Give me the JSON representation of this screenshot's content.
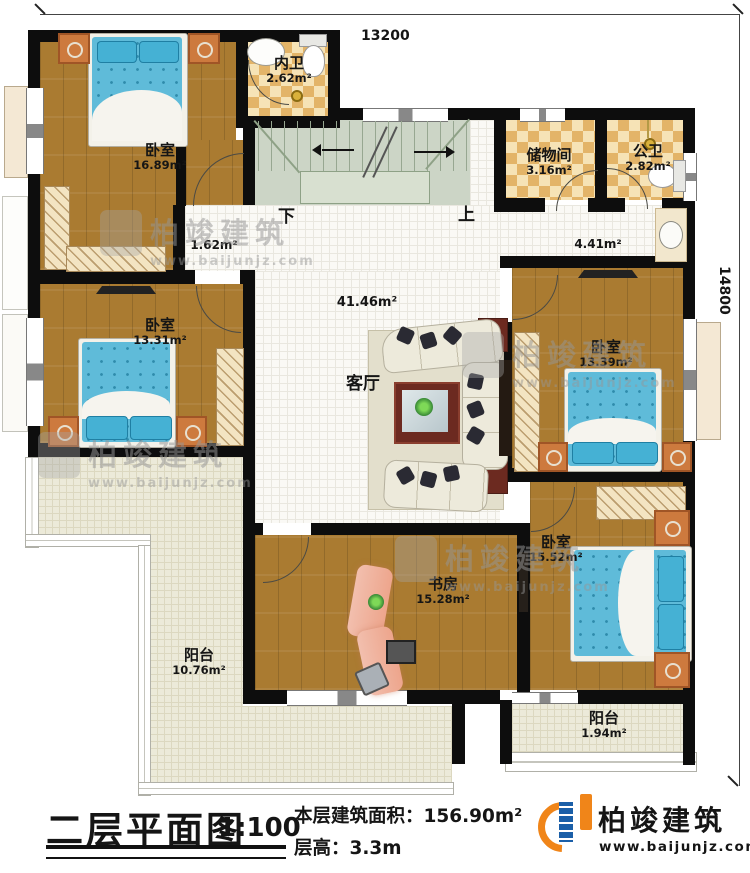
{
  "colors": {
    "wall": "#0d0d0d",
    "wood": "#aa7b31",
    "tile": "#e3b468",
    "tile_light": "#f6e3b6",
    "stairs": "#ccd5c6",
    "balcony": "#ecead9",
    "floor_white": "#faf9f5",
    "bed_blue": "#5fbbd9",
    "pillow_blue": "#45b1d4",
    "nightstand_orange": "#cd7a3e",
    "table_red": "#6c2a20",
    "desk_salmon": "#eda58c",
    "logo_blue": "#1b5fa8",
    "logo_orange": "#f08519"
  },
  "dimensions": {
    "top": "13200",
    "right": "14800"
  },
  "stairs": {
    "down": "下",
    "up": "上"
  },
  "rooms": {
    "bedroom_tl": {
      "name": "卧室",
      "area": "16.89m²"
    },
    "inner_bath": {
      "name": "内卫",
      "area": "2.62m²"
    },
    "storage": {
      "name": "储物间",
      "area": "3.16m²"
    },
    "public_bath": {
      "name": "公卫",
      "area": "2.82m²"
    },
    "hall_small": {
      "area": "1.62m²"
    },
    "hall_right": {
      "area": "4.41m²"
    },
    "living": {
      "name": "客厅",
      "area": "41.46m²"
    },
    "bedroom_ml": {
      "name": "卧室",
      "area": "13.31m²"
    },
    "bedroom_mr": {
      "name": "卧室",
      "area": "13.39m²"
    },
    "bedroom_br": {
      "name": "卧室",
      "area": "15.52m²"
    },
    "study": {
      "name": "书房",
      "area": "15.28m²"
    },
    "balcony_left": {
      "name": "阳台",
      "area": "10.76m²"
    },
    "balcony_right": {
      "name": "阳台",
      "area": "1.94m²"
    }
  },
  "titleblock": {
    "title": "二层平面图",
    "scale": "1:100",
    "area_line": "本层建筑面积：156.90m²",
    "height_line": "层高：3.3m"
  },
  "brand": {
    "name": "柏竣建筑",
    "url": "www.baijunjz.com"
  },
  "watermark": {
    "name": "柏竣建筑",
    "url": "www.baijunjz.com"
  }
}
